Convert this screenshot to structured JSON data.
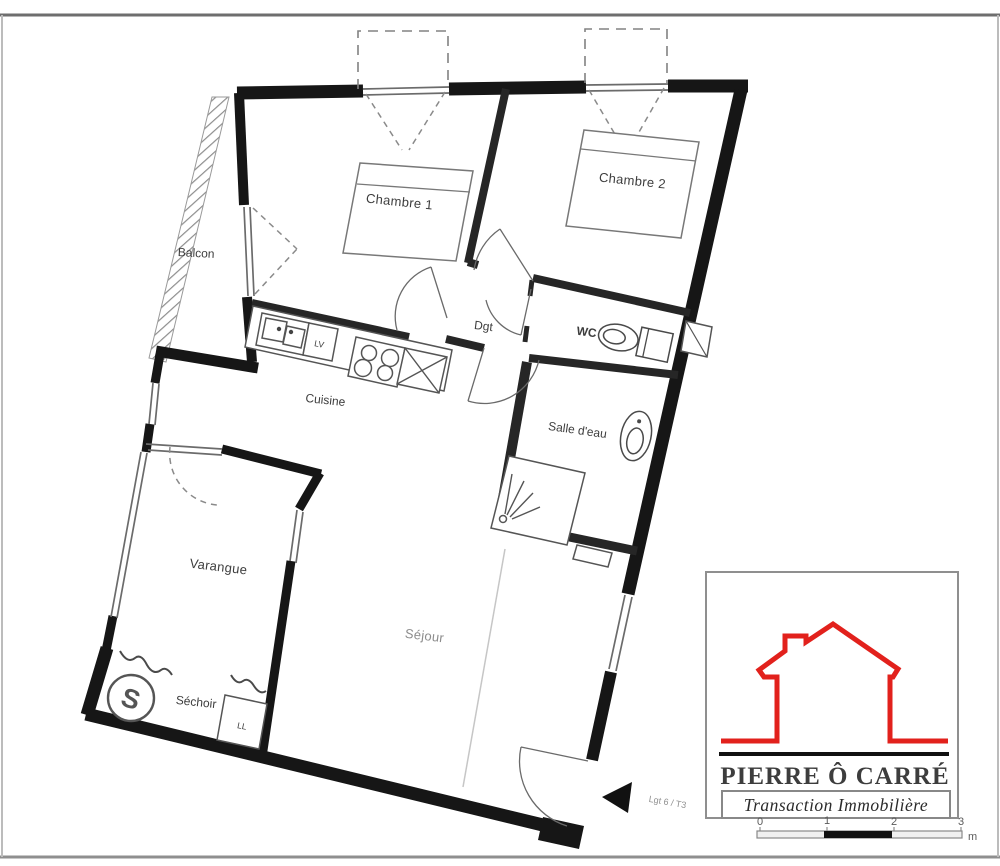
{
  "plan": {
    "rooms": {
      "balcon": "Balcon",
      "chambre1": "Chambre 1",
      "chambre2": "Chambre 2",
      "dgt": "Dgt",
      "wc": "WC",
      "salle_deau": "Salle d'eau",
      "cuisine": "Cuisine",
      "varangue": "Varangue",
      "sejour": "Séjour",
      "sechoir": "Séchoir"
    },
    "appliance_labels": {
      "dishwasher": "LV",
      "washing_machine": "LL"
    },
    "dryer_icon_glyph": "S",
    "unit_label": "Lgt 6 / T3"
  },
  "logo": {
    "name": "PIERRE Ô CARRÉ",
    "tagline": "Transaction Immobilière"
  },
  "scale_bar": {
    "ticks": [
      "0",
      "1",
      "2",
      "3"
    ],
    "unit": "m"
  },
  "colors": {
    "accent_red": "#e2211c",
    "wall": "#161616"
  }
}
